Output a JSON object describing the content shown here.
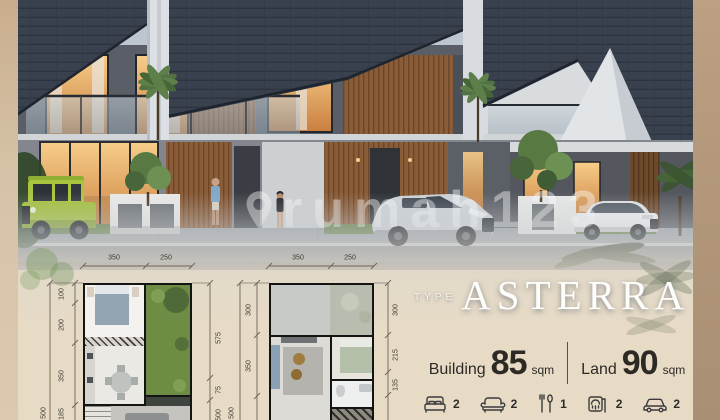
{
  "watermark": {
    "text": "rumah123",
    "logo": "map-pin-icon"
  },
  "type": {
    "label": "TYPE",
    "name": "ASTERRA"
  },
  "specs": {
    "building": {
      "label": "Building",
      "value": "85",
      "unit": "sqm"
    },
    "land": {
      "label": "Land",
      "value": "90",
      "unit": "sqm"
    }
  },
  "amenities": [
    {
      "name": "bedrooms",
      "icon": "bed-icon",
      "count": "2"
    },
    {
      "name": "living-rooms",
      "icon": "sofa-icon",
      "count": "2"
    },
    {
      "name": "dining-rooms",
      "icon": "dining-icon",
      "count": "1"
    },
    {
      "name": "bathrooms",
      "icon": "shower-icon",
      "count": "2"
    },
    {
      "name": "carports",
      "icon": "car-icon",
      "count": "2"
    }
  ],
  "floorplans": {
    "ground": {
      "top": [
        "350",
        "250"
      ],
      "left": [
        "100",
        "200",
        "350",
        "185"
      ],
      "left_outer": "500",
      "right": [
        "575",
        "75"
      ],
      "right_outer": "500"
    },
    "upper": {
      "top": [
        "350",
        "250"
      ],
      "left": [
        "300",
        "350"
      ],
      "left_outer": "500",
      "right": [
        "300",
        "215",
        "135"
      ]
    }
  },
  "colors": {
    "roof": "#39414e",
    "suv_green": "#a2bf3b",
    "beige_bg": "#e7dbc6",
    "side_strip": "#b2977a",
    "garden_green": "#6d8c44",
    "text_dark": "#2d2a26",
    "white": "#ffffff"
  }
}
